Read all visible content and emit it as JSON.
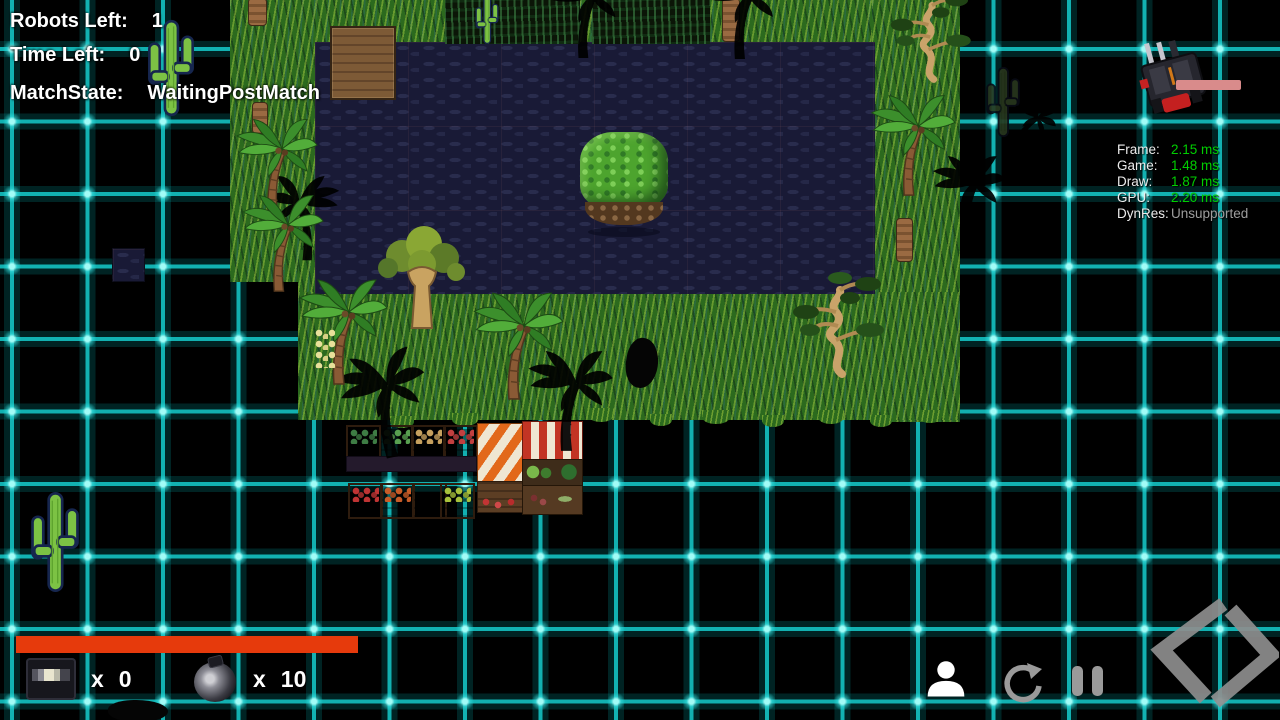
{
  "hud": {
    "robots_left_label": "Robots Left:",
    "robots_left_value": "1",
    "time_left_label": "Time Left:",
    "time_left_value": "0",
    "match_state_label": "MatchState:",
    "match_state_value": "WaitingPostMatch"
  },
  "perf": {
    "rows": [
      {
        "label": "Frame:",
        "value": "2.15 ms",
        "status": "good"
      },
      {
        "label": "Game:",
        "value": "1.48 ms",
        "status": "good"
      },
      {
        "label": "Draw:",
        "value": "1.87 ms",
        "status": "good"
      },
      {
        "label": "GPU:",
        "value": "2.20 ms",
        "status": "good"
      },
      {
        "label": "DynRes:",
        "value": "Unsupported",
        "status": "na"
      }
    ]
  },
  "counters": [
    {
      "icon": "ammo-box-icon",
      "times": "x",
      "count": "0"
    },
    {
      "icon": "bomb-icon",
      "times": "x",
      "count": "10"
    }
  ],
  "controls": {
    "icons": [
      "player-icon",
      "restart-icon",
      "pause-icon"
    ],
    "logo": "code-brackets-logo"
  },
  "colors": {
    "grid_line": "#12b1b1",
    "grid_node": "#59efe9",
    "hud_text": "#ffffff",
    "perf_good": "#00cf00",
    "perf_na": "#9d9d9d",
    "progress_orange": "#e63a0c",
    "health_pink": "#d98b8b",
    "icon_gray": "#9a9a9a",
    "water": "#191a36",
    "grass": "#2c6a1e"
  },
  "map": {
    "entities": [
      {
        "t": "grass",
        "x": 230,
        "y": 0,
        "w": 90,
        "h": 282
      },
      {
        "t": "grass",
        "x": 316,
        "y": 0,
        "w": 559,
        "h": 44
      },
      {
        "t": "grass",
        "x": 872,
        "y": 0,
        "w": 88,
        "h": 422
      },
      {
        "t": "grass",
        "x": 298,
        "y": 250,
        "w": 92,
        "h": 56
      },
      {
        "t": "grass",
        "x": 298,
        "y": 292,
        "w": 662,
        "h": 128
      },
      {
        "t": "jungle",
        "x": 445,
        "y": 0,
        "w": 135,
        "h": 44
      },
      {
        "t": "jungle",
        "x": 592,
        "y": 0,
        "w": 118,
        "h": 44
      },
      {
        "t": "water",
        "x": 315,
        "y": 42,
        "w": 560,
        "h": 252
      },
      {
        "t": "watertile",
        "x": 112,
        "y": 248,
        "w": 31,
        "h": 32
      },
      {
        "t": "dock",
        "x": 330,
        "y": 26,
        "w": 62,
        "h": 70
      },
      {
        "t": "island",
        "x": 580,
        "y": 132,
        "w": 88,
        "h": 100
      },
      {
        "t": "trunk",
        "x": 248,
        "y": -2,
        "w": 17,
        "h": 26
      },
      {
        "t": "trunk",
        "x": 252,
        "y": 102,
        "w": 14,
        "h": 30
      },
      {
        "t": "trunk",
        "x": 722,
        "y": -2,
        "w": 16,
        "h": 42
      },
      {
        "t": "trunk",
        "x": 896,
        "y": 218,
        "w": 15,
        "h": 42
      },
      {
        "t": "palm",
        "x": 226,
        "y": 112,
        "s": 92
      },
      {
        "t": "palm",
        "x": 232,
        "y": 188,
        "s": 92
      },
      {
        "t": "palm",
        "x": 860,
        "y": 88,
        "s": 96
      },
      {
        "t": "palm",
        "x": 288,
        "y": 272,
        "s": 100
      },
      {
        "t": "palm",
        "x": 462,
        "y": 285,
        "s": 102
      },
      {
        "t": "banana",
        "x": 315,
        "y": 328,
        "w": 20,
        "h": 40
      },
      {
        "t": "bigtree",
        "x": 372,
        "y": 222,
        "s": 100
      },
      {
        "t": "bonsai",
        "x": 790,
        "y": 268,
        "s": 100
      },
      {
        "t": "bonsai",
        "x": 888,
        "y": -14,
        "s": 88
      },
      {
        "t": "cactus",
        "x": 145,
        "y": 6,
        "w": 52,
        "h": 124
      },
      {
        "t": "cactus",
        "x": 28,
        "y": 484,
        "w": 54,
        "h": 116
      },
      {
        "t": "cactus",
        "x": 471,
        "y": -6,
        "w": 32,
        "h": 52
      },
      {
        "t": "darkcactus",
        "x": 984,
        "y": 38,
        "w": 38,
        "h": 128
      },
      {
        "t": "palmshadow",
        "x": 268,
        "y": 170,
        "s": 80,
        "f": 1
      },
      {
        "t": "palmshadow",
        "x": 330,
        "y": 346,
        "s": 100,
        "r": -12
      },
      {
        "t": "palmshadow",
        "x": 518,
        "y": 344,
        "s": 95
      },
      {
        "t": "palmshadow",
        "x": 540,
        "y": -38,
        "s": 85
      },
      {
        "t": "palmshadow",
        "x": 695,
        "y": -40,
        "s": 88
      },
      {
        "t": "palmshadow",
        "x": 924,
        "y": 150,
        "s": 82
      },
      {
        "t": "palmshadow",
        "x": 1002,
        "y": 92,
        "s": 52,
        "r": 32
      },
      {
        "t": "blob",
        "x": 626,
        "y": 338,
        "w": 32,
        "h": 50,
        "r": 8
      },
      {
        "t": "blob",
        "x": 108,
        "y": 700,
        "w": 60,
        "h": 22,
        "r": 0
      },
      {
        "t": "tuft",
        "x": 390,
        "y": 416,
        "w": 24,
        "h": 12
      },
      {
        "t": "tuft",
        "x": 452,
        "y": 413,
        "w": 26,
        "h": 13
      },
      {
        "t": "tuft",
        "x": 588,
        "y": 408,
        "w": 26,
        "h": 14
      },
      {
        "t": "tuft",
        "x": 650,
        "y": 414,
        "w": 22,
        "h": 12
      },
      {
        "t": "tuft",
        "x": 702,
        "y": 410,
        "w": 28,
        "h": 14
      },
      {
        "t": "tuft",
        "x": 762,
        "y": 415,
        "w": 22,
        "h": 12
      },
      {
        "t": "tuft",
        "x": 818,
        "y": 410,
        "w": 26,
        "h": 14
      },
      {
        "t": "tuft",
        "x": 870,
        "y": 415,
        "w": 22,
        "h": 12
      },
      {
        "t": "tuft",
        "x": 918,
        "y": 410,
        "w": 24,
        "h": 13
      },
      {
        "t": "crate",
        "x": 346,
        "y": 425,
        "c": "#3e7c44"
      },
      {
        "t": "crate",
        "x": 379,
        "y": 425,
        "c": "#58a050"
      },
      {
        "t": "crate",
        "x": 411,
        "y": 425,
        "c": "#c6a05e"
      },
      {
        "t": "crate",
        "x": 443,
        "y": 425,
        "c": "#c24040"
      },
      {
        "t": "shelf",
        "x": 346,
        "y": 456,
        "w": 129,
        "h": 14
      },
      {
        "t": "crate",
        "x": 348,
        "y": 483,
        "c": "#bf3434"
      },
      {
        "t": "crate",
        "x": 380,
        "y": 483,
        "c": "#c85c28"
      },
      {
        "t": "crate",
        "x": 412,
        "y": 483,
        "c": ""
      },
      {
        "t": "crate",
        "x": 440,
        "y": 483,
        "c": "#a8c23c"
      },
      {
        "t": "stallA",
        "x": 477,
        "y": 423,
        "w": 47,
        "h": 90
      },
      {
        "t": "stallB",
        "x": 522,
        "y": 421,
        "w": 61,
        "h": 94
      }
    ]
  }
}
